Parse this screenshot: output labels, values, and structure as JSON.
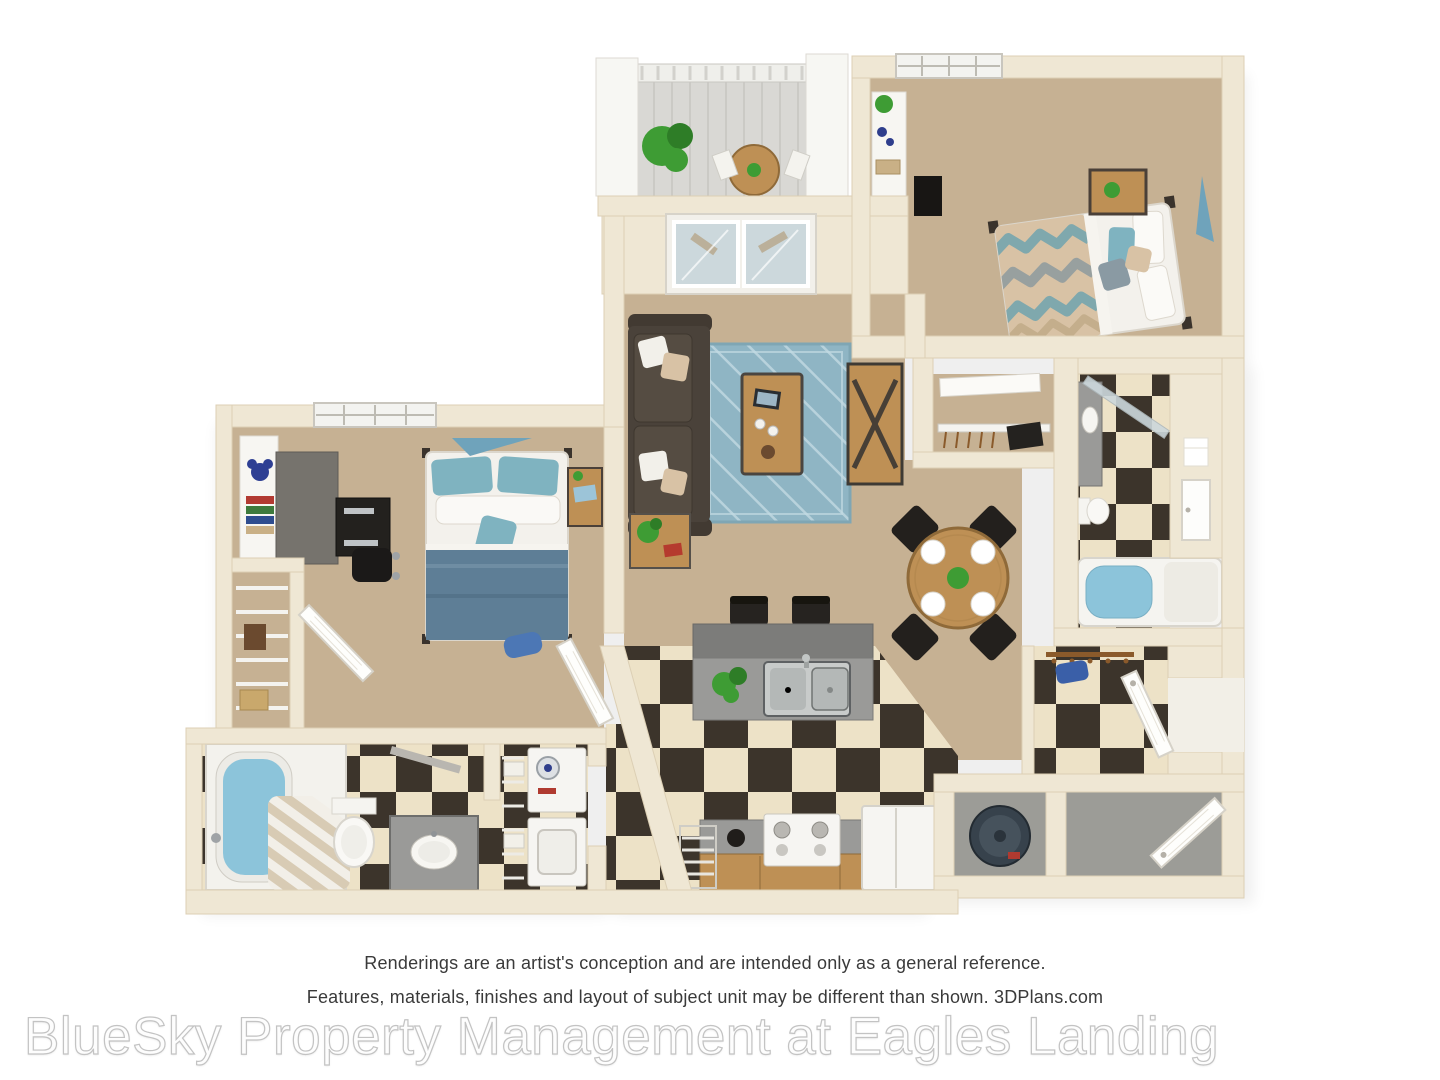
{
  "disclaimer": {
    "line1": "Renderings are an artist's conception and are intended only as a general reference.",
    "line2": "Features, materials, finishes and layout of subject unit may be different than shown. 3DPlans.com"
  },
  "watermark": {
    "text": "BlueSky Property Management at Eagles Landing"
  },
  "palette": {
    "wall": "#EFE7D4",
    "wallEdge": "#DCCFB4",
    "carpet": "#C6B193",
    "checkerDark": "#3C342B",
    "checkerLight": "#EDE2C7",
    "balconyFloor": "#D9D8D4",
    "rug": "#8FB5C4",
    "rugLine": "#C2DAE2",
    "sofa": "#4A423A",
    "sofaCushion": "#554C42",
    "wood": "#BE9055",
    "woodDark": "#8F6A39",
    "granite": "#9A9A98",
    "graniteDark": "#7C7C7A",
    "whiteF": "#F6F5F1",
    "blanketBlue": "#5E7E96",
    "pillowTeal": "#7FB3C0",
    "patternTan": "#D8C2A5",
    "patternTeal": "#7FA8AD",
    "water": "#8CC4DA",
    "plant": "#3E9C34",
    "plantDark": "#2E7D27",
    "blackF": "#201D1A",
    "concrete": "#9C9C97",
    "glass": "#CCD8DC",
    "doorEdge": "#D6D2C8",
    "textInk": "#3A3A3A",
    "watermarkStroke": "#C3C3C3"
  },
  "floorplan": {
    "type": "3d-rendered-apartment-floor-plan",
    "bedrooms": 2,
    "bathrooms": 2,
    "rooms": [
      {
        "name": "Balcony",
        "items": [
          "white columns",
          "railing",
          "potted plant",
          "bistro table",
          "patio chairs"
        ]
      },
      {
        "name": "Living Room",
        "items": [
          "dark sofa with pillows",
          "blue area rug",
          "wood coffee table with tablet",
          "media console",
          "wall tv",
          "end table with plant"
        ]
      },
      {
        "name": "Sunroom Doors",
        "items": [
          "sliding glass doors"
        ]
      },
      {
        "name": "Bedroom 1",
        "items": [
          "bed with chevron bedding",
          "nightstand with plant",
          "white dresser",
          "tv",
          "window",
          "teal wall art",
          "closet with wire shelf"
        ]
      },
      {
        "name": "Bedroom 2",
        "items": [
          "bed with blue bedding",
          "nightstand with laptop",
          "desk and chair",
          "bookshelf",
          "window",
          "teal wall art",
          "wire closet",
          "duffel bag"
        ]
      },
      {
        "name": "Bathroom 1",
        "items": [
          "bathtub",
          "striped shower curtain",
          "toilet",
          "granite vanity"
        ]
      },
      {
        "name": "Laundry Closet",
        "items": [
          "washer",
          "dryer",
          "wire shelving",
          "baskets"
        ]
      },
      {
        "name": "Kitchen",
        "items": [
          "granite island with double sink",
          "two bar stools",
          "range",
          "refrigerator",
          "pantry shelving",
          "wood cabinets",
          "checkered floor"
        ]
      },
      {
        "name": "Dining Area",
        "items": [
          "round wood table",
          "four black chairs",
          "four place settings",
          "centerpiece plant"
        ]
      },
      {
        "name": "Bathroom 2",
        "items": [
          "granite vanity",
          "toilet",
          "bathtub",
          "glass shower door",
          "towel",
          "door"
        ]
      },
      {
        "name": "Entry",
        "items": [
          "front door",
          "coat hooks",
          "blue bag",
          "checkered floor"
        ]
      },
      {
        "name": "Storage Closet",
        "items": [
          "exterior door",
          "concrete floor"
        ]
      },
      {
        "name": "Utility Closet",
        "items": [
          "water heater"
        ]
      }
    ]
  }
}
